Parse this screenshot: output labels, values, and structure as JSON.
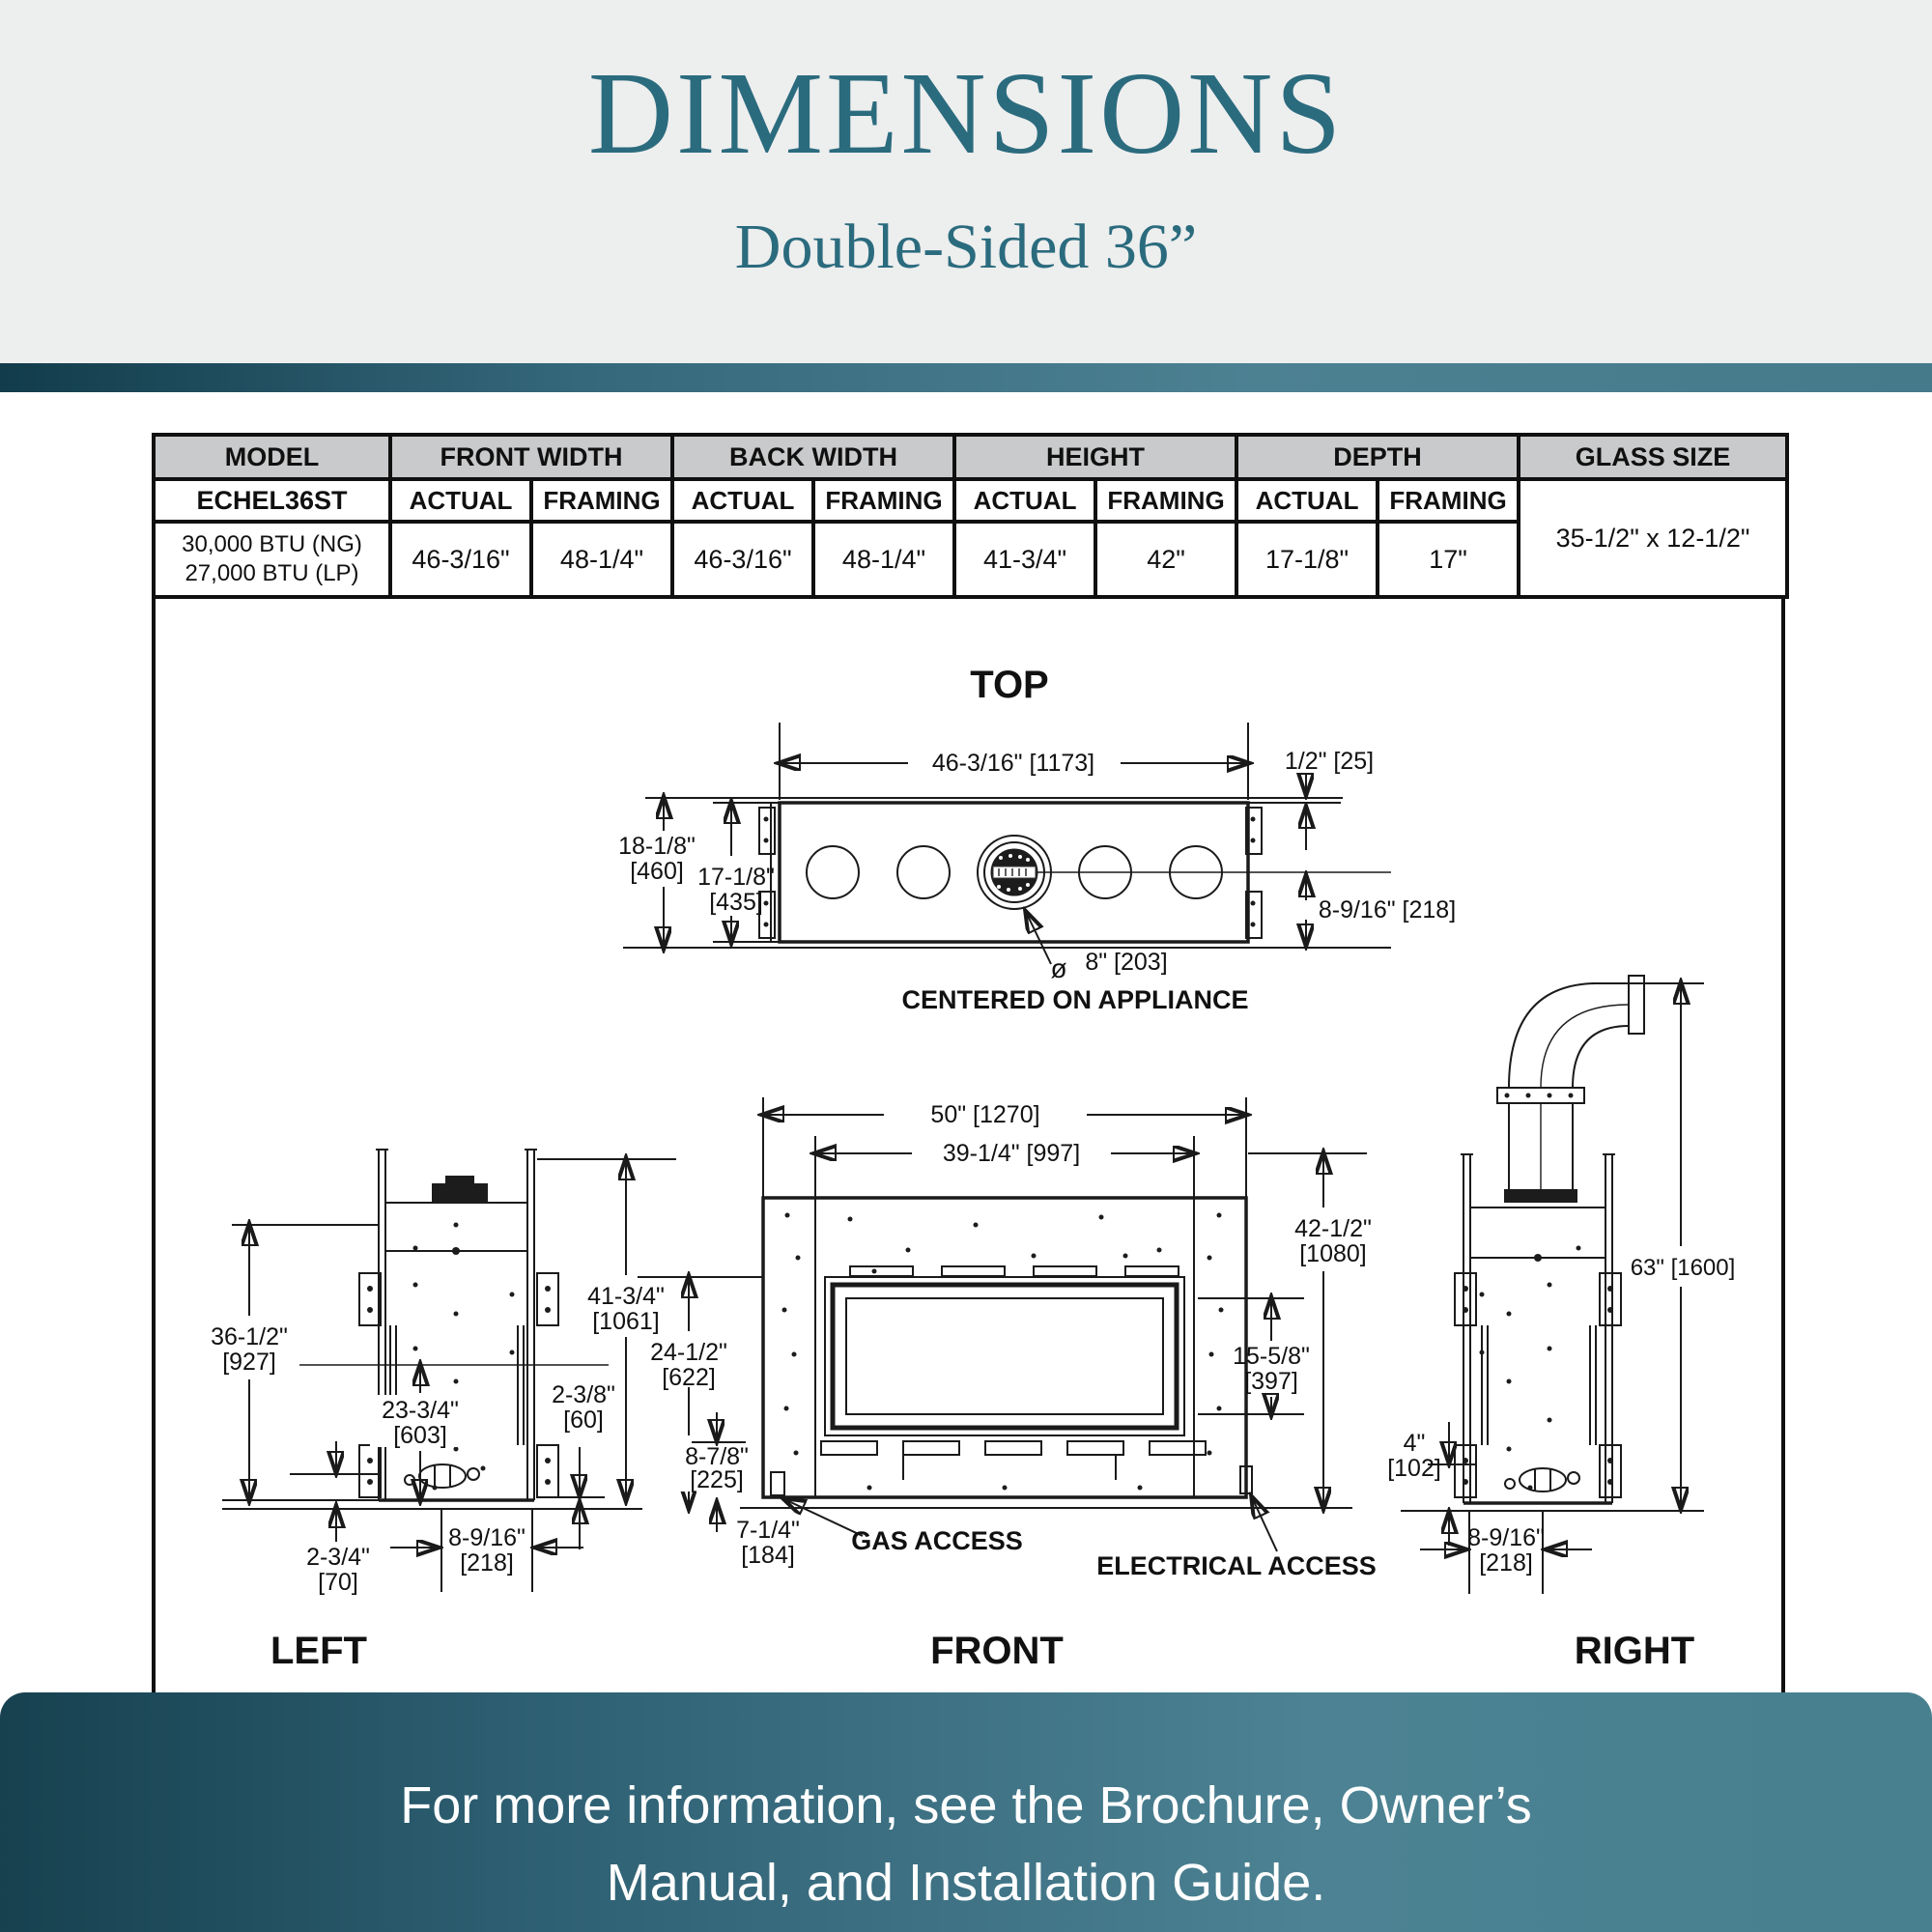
{
  "page": {
    "accent_teal": "#2b6b7e",
    "divider_gradient": [
      "#123c4b",
      "#4c8192"
    ],
    "footer_gradient": [
      "#17414f",
      "#4c8293"
    ],
    "table_header_bg": "#c9cacb",
    "header_bg": "#edeeee",
    "line_color": "#1a1a1a"
  },
  "header": {
    "title": "DIMENSIONS",
    "subtitle": "Double-Sided 36”"
  },
  "spec_table": {
    "headers": {
      "model": "MODEL",
      "front_width": "FRONT WIDTH",
      "back_width": "BACK WIDTH",
      "height": "HEIGHT",
      "depth": "DEPTH",
      "glass_size": "GLASS SIZE",
      "actual": "ACTUAL",
      "framing": "FRAMING"
    },
    "model": "ECHEL36ST",
    "model_btu_ng": "30,000 BTU (NG)",
    "model_btu_lp": "27,000 BTU (LP)",
    "front_width": {
      "actual": "46-3/16\"",
      "framing": "48-1/4\""
    },
    "back_width": {
      "actual": "46-3/16\"",
      "framing": "48-1/4\""
    },
    "height": {
      "actual": "41-3/4\"",
      "framing": "42\""
    },
    "depth": {
      "actual": "17-1/8\"",
      "framing": "17\""
    },
    "glass_size": "35-1/2\" x 12-1/2\""
  },
  "diagrams": {
    "top": {
      "title": "TOP",
      "width": "46-3/16\" [1173]",
      "gap": "1/2\" [25]",
      "overall_depth_l1": "18-1/8\"",
      "overall_depth_l2": "[460]",
      "appliance_depth_l1": "17-1/8\"",
      "appliance_depth_l2": "[435]",
      "flue_to_back": "8-9/16\" [218]",
      "dia_symbol": "ø",
      "flue_dia": "8\" [203]",
      "note": "CENTERED ON APPLIANCE"
    },
    "left": {
      "title": "LEFT",
      "overall_height_l1": "36-1/2\"",
      "overall_height_l2": "[927]",
      "mid_height_l1": "23-3/4\"",
      "mid_height_l2": "[603]",
      "framing_height_l1": "41-3/4\"",
      "framing_height_l2": "[1061]",
      "standoff_l1": "2-3/8\"",
      "standoff_l2": "[60]",
      "base_l1": "2-3/4\"",
      "base_l2": "[70]",
      "gas_offset_l1": "8-9/16\"",
      "gas_offset_l2": "[218]"
    },
    "front": {
      "title": "FRONT",
      "framing_width": "50\" [1270]",
      "opening_width": "39-1/4\" [997]",
      "opening_height_l1": "24-1/2\"",
      "opening_height_l2": "[622]",
      "lower_height_l1": "8-7/8\"",
      "lower_height_l2": "[225]",
      "gas_height_l1": "7-1/4\"",
      "gas_height_l2": "[184]",
      "overall_height_l1": "42-1/2\"",
      "overall_height_l2": "[1080]",
      "glass_height_l1": "15-5/8\"",
      "glass_height_l2": "[397]",
      "gas_access": "GAS ACCESS",
      "electrical_access": "ELECTRICAL ACCESS"
    },
    "right": {
      "title": "RIGHT",
      "total_height": "63\" [1600]",
      "clearance_l1": "4\"",
      "clearance_l2": "[102]",
      "gas_offset_l1": "8-9/16\"",
      "gas_offset_l2": "[218]"
    }
  },
  "footer": {
    "line1": "For more information, see the Brochure, Owner’s",
    "line2": "Manual, and Installation Guide."
  }
}
